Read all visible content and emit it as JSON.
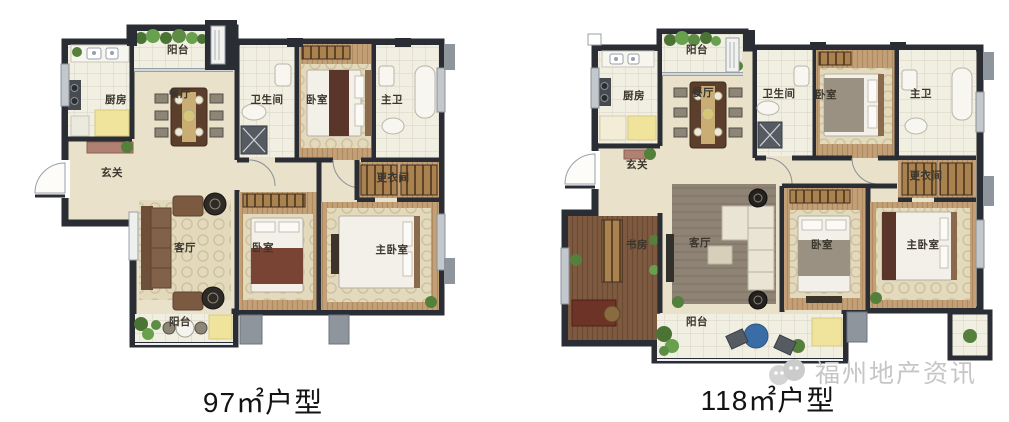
{
  "plans": [
    {
      "caption": "97㎡户型",
      "rooms": [
        {
          "name": "balcony-top",
          "label": "阳台"
        },
        {
          "name": "kitchen",
          "label": "厨房"
        },
        {
          "name": "dining",
          "label": "餐厅"
        },
        {
          "name": "bathroom",
          "label": "卫生间"
        },
        {
          "name": "bedroom-2",
          "label": "卧室"
        },
        {
          "name": "master-bathroom",
          "label": "主卫"
        },
        {
          "name": "foyer",
          "label": "玄关"
        },
        {
          "name": "walk-in-closet",
          "label": "更衣间"
        },
        {
          "name": "living-room",
          "label": "客厅"
        },
        {
          "name": "bedroom-1",
          "label": "卧室"
        },
        {
          "name": "master-bedroom",
          "label": "主卧室"
        },
        {
          "name": "balcony-bottom",
          "label": "阳台"
        }
      ]
    },
    {
      "caption": "118㎡户型",
      "rooms": [
        {
          "name": "balcony-top",
          "label": "阳台"
        },
        {
          "name": "kitchen",
          "label": "厨房"
        },
        {
          "name": "dining",
          "label": "餐厅"
        },
        {
          "name": "bathroom",
          "label": "卫生间"
        },
        {
          "name": "bedroom-2",
          "label": "卧室"
        },
        {
          "name": "master-bathroom",
          "label": "主卫"
        },
        {
          "name": "foyer",
          "label": "玄关"
        },
        {
          "name": "walk-in-closet",
          "label": "更衣间"
        },
        {
          "name": "study",
          "label": "书房"
        },
        {
          "name": "living-room",
          "label": "客厅"
        },
        {
          "name": "bedroom-1",
          "label": "卧室"
        },
        {
          "name": "master-bedroom",
          "label": "主卧室"
        },
        {
          "name": "balcony-bottom",
          "label": "阳台"
        }
      ]
    }
  ],
  "watermark": {
    "text": "福州地产资讯"
  },
  "colors": {
    "wall": "#2a2e34",
    "floor_cream": "#e9e1ca",
    "wood": "#c3a078",
    "wood_dark": "#7d5a40",
    "accent_green": "#55803c",
    "accent_yellow": "#f0e49c",
    "accent_blue": "#3a6da5",
    "caption_text": "#131313",
    "watermark_gray": "#c6c6c6"
  }
}
